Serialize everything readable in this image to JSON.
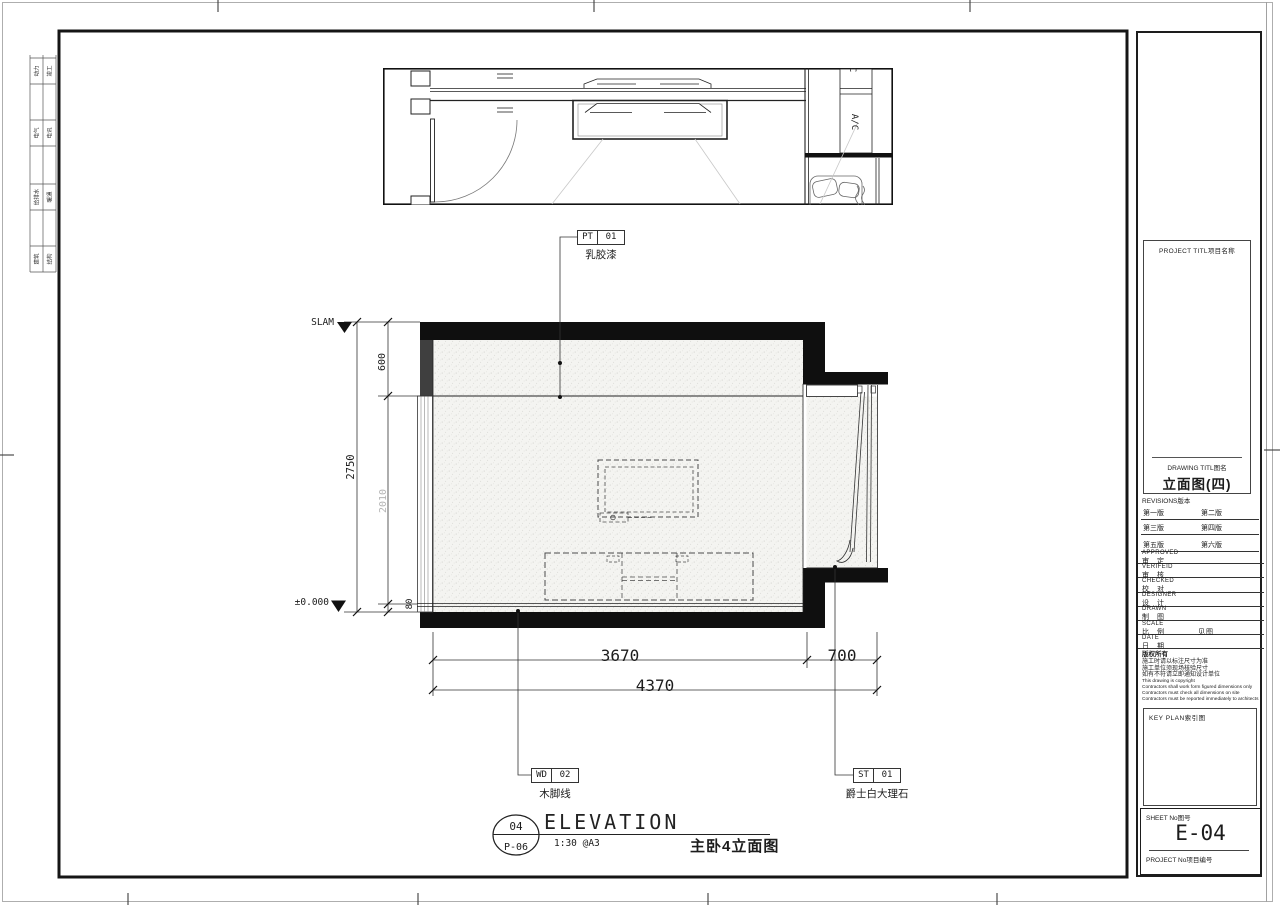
{
  "sheet": {
    "edge_stamps": [
      {
        "left": "动力",
        "right": "竣工"
      },
      {
        "left": "电气",
        "right": "电讯"
      },
      {
        "left": "给排水",
        "right": "暖通"
      },
      {
        "left": "建筑",
        "right": "结构"
      }
    ]
  },
  "plan": {
    "ac_label": "A/C"
  },
  "elevation": {
    "levels": {
      "top": "SLAM",
      "bottom": "±0.000"
    },
    "dims": {
      "v_total": "2750",
      "v_top": "600",
      "v_mid": "2010",
      "v_skirt": "80",
      "h_left": "3670",
      "h_right": "700",
      "h_total": "4370"
    },
    "tags": [
      {
        "code": "PT",
        "num": "01",
        "desc": "乳胶漆"
      },
      {
        "code": "WD",
        "num": "02",
        "desc": "木脚线"
      },
      {
        "code": "ST",
        "num": "01",
        "desc": "爵士白大理石"
      }
    ]
  },
  "view_title": {
    "number": "04",
    "sheet_ref": "P-06",
    "name": "ELEVATION",
    "scale": "1:30 @A3",
    "cn_name": "主卧4立面图"
  },
  "title_block": {
    "project_label": "PROJECT TITL项目名称",
    "drawing_label": "DRAWING TITL图名",
    "drawing_name": "立面图(四)",
    "revisions_label": "REVISIONS版本",
    "revisions": [
      "第一版",
      "第二版",
      "第三版",
      "第四版",
      "第五版",
      "第六版"
    ],
    "fields": [
      {
        "en": "APPROVED",
        "cn": "审 定",
        "value": ""
      },
      {
        "en": "VERIFEID",
        "cn": "审 核",
        "value": ""
      },
      {
        "en": "CHECKED",
        "cn": "校 对",
        "value": ""
      },
      {
        "en": "DESIGNER",
        "cn": "设 计",
        "value": ""
      },
      {
        "en": "DRAWN",
        "cn": "制 图",
        "value": ""
      },
      {
        "en": "SCALE",
        "cn": "比 例",
        "value": "见图"
      },
      {
        "en": "DATE",
        "cn": "日 期",
        "value": ""
      }
    ],
    "copyright_cn": [
      "版权所有",
      "施工时请以标注尺寸为准",
      "施工单位须现场核验尺寸",
      "如有不符请立即通知设计单位"
    ],
    "copyright_en": [
      "This drawing is copyright",
      "Contractors shall work form figured dimensions only",
      "Contractors must check all dimensions on site",
      "Contractors must be reported immediately to architects"
    ],
    "keyplan_label": "KEY PLAN索引图",
    "sheet_no_label": "SHEET No图号",
    "sheet_no": "E-04",
    "project_no_label": "PROJECT No项目编号"
  },
  "colors": {
    "line": "#1a1a1a",
    "fill_dark": "#3f3f3f",
    "dim_gray": "#b5b5b5"
  }
}
